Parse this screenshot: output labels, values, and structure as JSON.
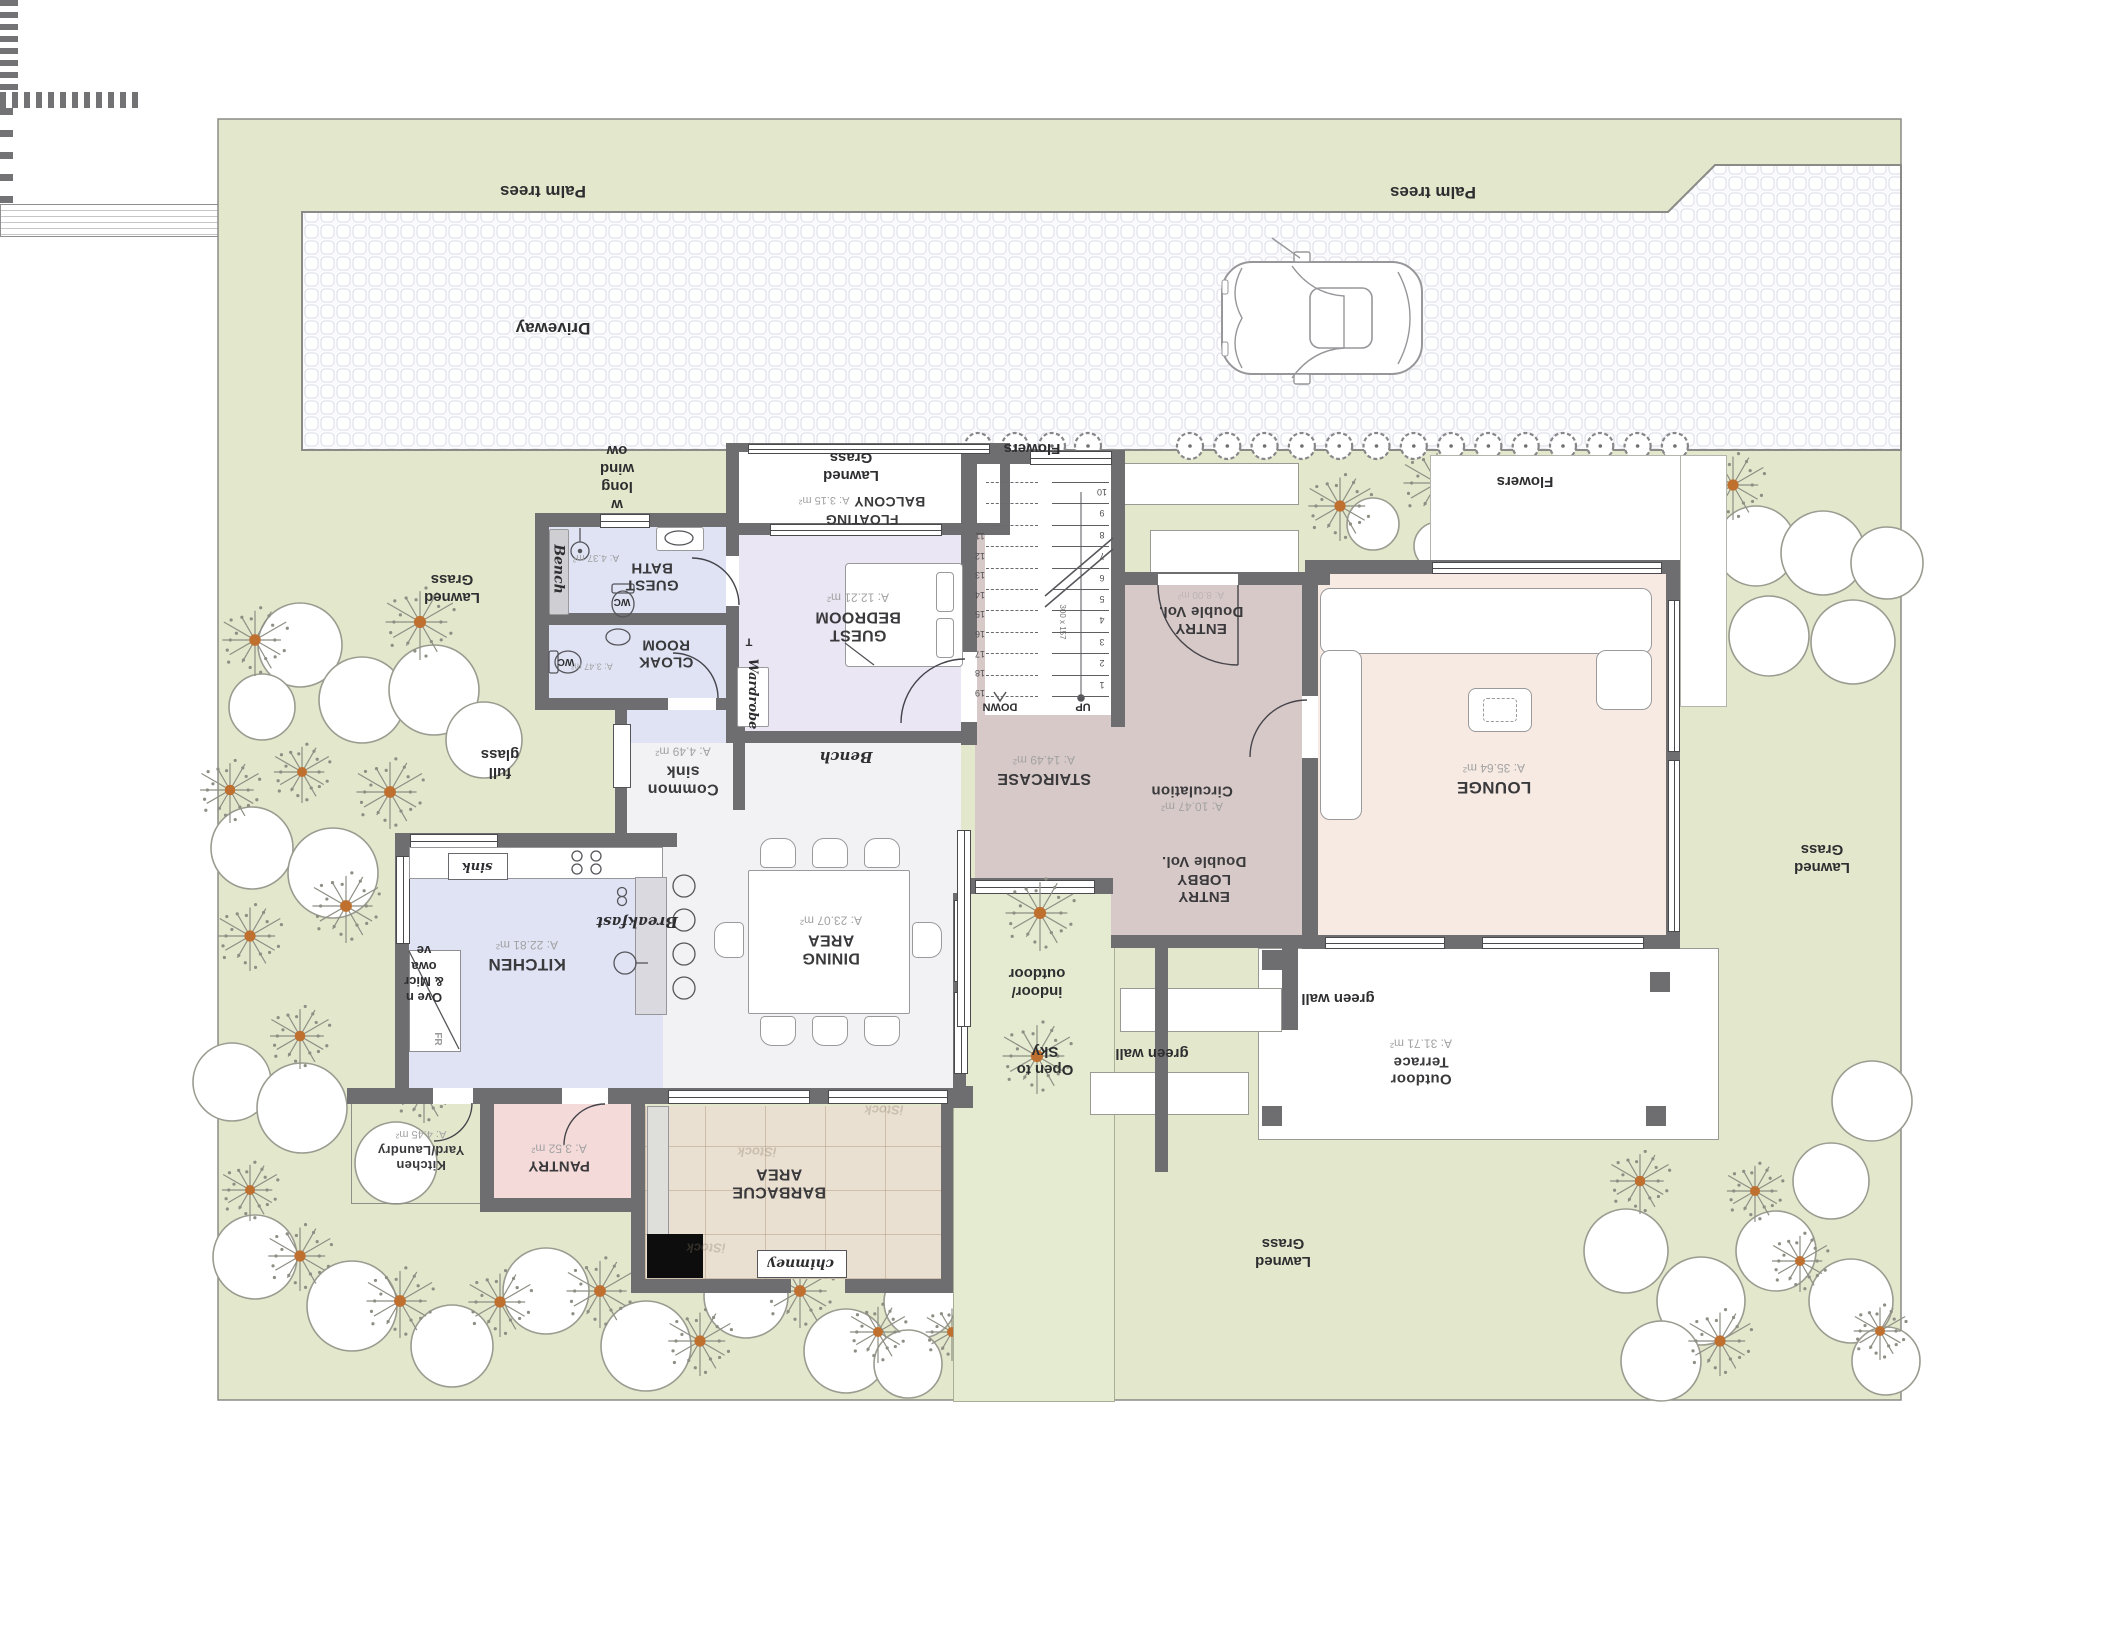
{
  "landscape": {
    "palm_trees": "Palm trees",
    "driveway": "Driveway",
    "flowers": "Flowers",
    "lawned_grass": "Lawned Grass",
    "full_glass": "full glass",
    "long_window": "w long wind ow",
    "green_wall": "green wall",
    "indoor_outdoor": "indoor/ outdoor",
    "open_to_sky": "Open to Sky"
  },
  "rooms": {
    "guest_bath": {
      "name": "GUEST BATH",
      "area": "A: 4.37 m²"
    },
    "cloak_room": {
      "name": "CLOAK ROOM",
      "area": "A: 3.47 m²"
    },
    "common_sink": {
      "name": "Common sink",
      "area": "A: 4.49 m²"
    },
    "kitchen": {
      "name": "KITCHEN",
      "area": "A: 22.81 m²"
    },
    "pantry": {
      "name": "PANTRY",
      "area": "A: 3.52 m²"
    },
    "kitchen_yard": {
      "name": "Kitchen Yard/Laundry",
      "area": "A: 4.45 m²"
    },
    "barbacue": {
      "name": "BARBACUE AREA"
    },
    "dining": {
      "name": "DINING AREA",
      "area": "A: 23.07 m²"
    },
    "guest_bedroom": {
      "name": "GUEST BEDROOM",
      "area": "A: 12.21 m²"
    },
    "floating_balcony": {
      "name": "FLOATING BALCONY",
      "area": "A: 3.15 m²"
    },
    "staircase": {
      "name": "STAIRCASE",
      "area": "A: 14.49 m²"
    },
    "entry": {
      "name": "ENTRY Double Vol.",
      "area": "A: 8.00 m²"
    },
    "circulation": {
      "name": "Circulation",
      "area": "A: 10.47 m²"
    },
    "entry_lobby": {
      "name": "ENTRY LOBBY Double Vol."
    },
    "lounge": {
      "name": "LOUNGE",
      "area": "A: 35.64 m²"
    },
    "outdoor_terrace": {
      "name": "Outdoor Terrace",
      "area": "A: 31.71 m²"
    }
  },
  "fixtures": {
    "bench": "Bench",
    "wardrobe": "Wardrobe",
    "wardrobe_t": "T",
    "breakfast": "Breakfast",
    "sink": "sink",
    "fridge": "FR",
    "wc": "WC",
    "chimney": "chimney",
    "oven_microwave": "Ove n & Micr owa ve"
  },
  "stairs": {
    "up": "UP",
    "down": "DOWN",
    "tread": "300 x 157",
    "numbers_lower": [
      "1",
      "2",
      "3",
      "4",
      "5",
      "6",
      "7",
      "8",
      "9",
      "10"
    ],
    "numbers_upper": [
      "11",
      "12",
      "13",
      "14",
      "15",
      "16",
      "17",
      "18",
      "19"
    ]
  },
  "watermark": "iStock",
  "colors": {
    "lawn": "#e3e8cd",
    "courtyard": "#e5ebd1",
    "wall": "#6e6e70",
    "bath_floor": "#dfe3f4",
    "bedroom_floor": "#eae6f4",
    "dining_floor": "#f2f2f4",
    "lounge_floor": "#f7eae2",
    "mauve_floor": "#d8c9c9",
    "pantry_floor": "#f5dada",
    "tree_accent": "#bf6f2e"
  }
}
